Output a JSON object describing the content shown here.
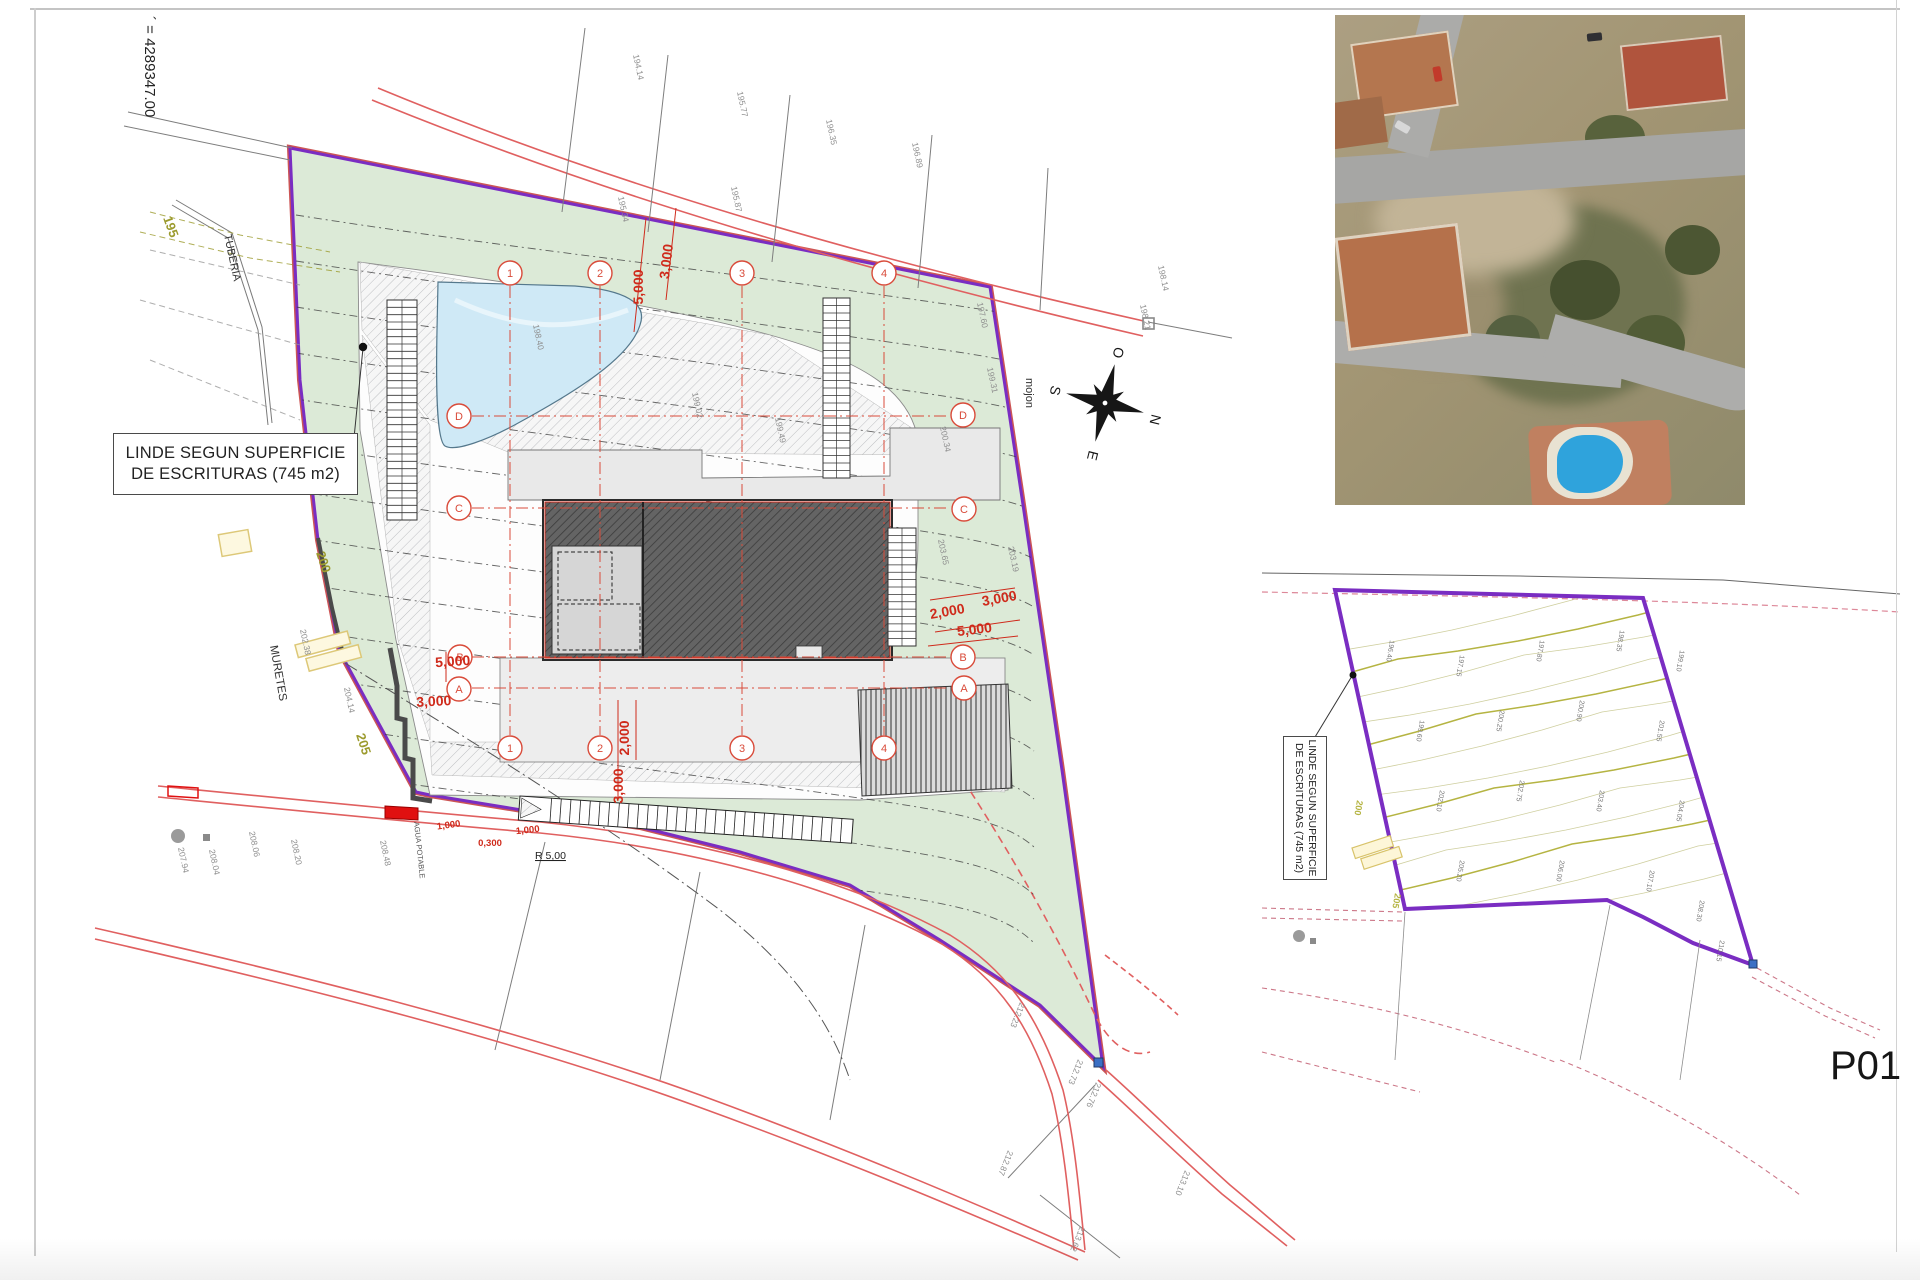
{
  "site_plan": {
    "coordinate_label": "´ = 4289347.00",
    "linde_label_line1": "LINDE SEGUN SUPERFICIE",
    "linde_label_line2": "DE ESCRITURAS (745 m2)",
    "mojon_label": "mojon",
    "tuberia_label": "TUBERIA",
    "muretes_label": "MURETES",
    "agua_potable_label": "AGUA POTABLE",
    "radius_label": "R 5,00",
    "compass": {
      "n": "N",
      "s": "S",
      "e": "E",
      "o": "O"
    },
    "contour_labels": [
      {
        "x": 163,
        "y": 218,
        "r": 70,
        "text": "195"
      },
      {
        "x": 316,
        "y": 553,
        "r": 72,
        "text": "200"
      },
      {
        "x": 356,
        "y": 735,
        "r": 72,
        "text": "205"
      }
    ],
    "grid_bubbles": [
      {
        "x": 510,
        "y": 273,
        "label": "1"
      },
      {
        "x": 600,
        "y": 273,
        "label": "2"
      },
      {
        "x": 742,
        "y": 273,
        "label": "3"
      },
      {
        "x": 884,
        "y": 273,
        "label": "4"
      },
      {
        "x": 510,
        "y": 748,
        "label": "1"
      },
      {
        "x": 600,
        "y": 748,
        "label": "2"
      },
      {
        "x": 742,
        "y": 748,
        "label": "3"
      },
      {
        "x": 884,
        "y": 748,
        "label": "4"
      },
      {
        "x": 459,
        "y": 416,
        "label": "D"
      },
      {
        "x": 459,
        "y": 508,
        "label": "C"
      },
      {
        "x": 460,
        "y": 657,
        "label": "B"
      },
      {
        "x": 459,
        "y": 689,
        "label": "A"
      },
      {
        "x": 963,
        "y": 415,
        "label": "D"
      },
      {
        "x": 964,
        "y": 509,
        "label": "C"
      },
      {
        "x": 963,
        "y": 657,
        "label": "B"
      },
      {
        "x": 964,
        "y": 688,
        "label": "A"
      }
    ],
    "dimensions": [
      {
        "x": 643,
        "y": 287,
        "r": -90,
        "text": "5,000"
      },
      {
        "x": 671,
        "y": 262,
        "r": -83,
        "text": "3,000"
      },
      {
        "x": 948,
        "y": 616,
        "r": -10,
        "text": "2,000"
      },
      {
        "x": 1000,
        "y": 603,
        "r": -10,
        "text": "3,000"
      },
      {
        "x": 975,
        "y": 634,
        "r": -7,
        "text": "5,000"
      },
      {
        "x": 453,
        "y": 666,
        "r": -4,
        "text": "5,000"
      },
      {
        "x": 434,
        "y": 706,
        "r": -3,
        "text": "3,000"
      },
      {
        "x": 629,
        "y": 738,
        "r": -90,
        "text": "2,000"
      },
      {
        "x": 623,
        "y": 786,
        "r": -90,
        "text": "3,000"
      },
      {
        "x": 449,
        "y": 828,
        "r": -8,
        "text": "1,000",
        "size": 9.5
      },
      {
        "x": 528,
        "y": 833,
        "r": -6,
        "text": "1,000",
        "size": 9.5
      },
      {
        "x": 490,
        "y": 846,
        "r": 0,
        "text": "0,300",
        "size": 9.5
      }
    ],
    "survey_points": [
      {
        "x": 633,
        "y": 55,
        "r": 78,
        "text": "194.14"
      },
      {
        "x": 737,
        "y": 92,
        "r": 78,
        "text": "195.77"
      },
      {
        "x": 826,
        "y": 120,
        "r": 78,
        "text": "196.35"
      },
      {
        "x": 912,
        "y": 143,
        "r": 78,
        "text": "196.89"
      },
      {
        "x": 618,
        "y": 197,
        "r": 78,
        "text": "195.34"
      },
      {
        "x": 731,
        "y": 187,
        "r": 78,
        "text": "195.87"
      },
      {
        "x": 1158,
        "y": 266,
        "r": 78,
        "text": "198.14"
      },
      {
        "x": 1140,
        "y": 305,
        "r": 78,
        "text": "198.21"
      },
      {
        "x": 977,
        "y": 303,
        "r": 78,
        "text": "197.60"
      },
      {
        "x": 987,
        "y": 368,
        "r": 78,
        "text": "199.31"
      },
      {
        "x": 940,
        "y": 427,
        "r": 78,
        "text": "200.34"
      },
      {
        "x": 938,
        "y": 540,
        "r": 78,
        "text": "203.65"
      },
      {
        "x": 1008,
        "y": 547,
        "r": 78,
        "text": "203.19"
      },
      {
        "x": 533,
        "y": 325,
        "r": 78,
        "text": "198.40"
      },
      {
        "x": 692,
        "y": 393,
        "r": 78,
        "text": "199.02"
      },
      {
        "x": 775,
        "y": 418,
        "r": 78,
        "text": "199.49"
      },
      {
        "x": 300,
        "y": 630,
        "r": 78,
        "text": "202.38"
      },
      {
        "x": 344,
        "y": 688,
        "r": 78,
        "text": "204.14"
      },
      {
        "x": 178,
        "y": 848,
        "r": 78,
        "text": "207.94"
      },
      {
        "x": 209,
        "y": 850,
        "r": 78,
        "text": "208.04"
      },
      {
        "x": 249,
        "y": 832,
        "r": 78,
        "text": "208.06"
      },
      {
        "x": 291,
        "y": 840,
        "r": 78,
        "text": "208.20"
      },
      {
        "x": 380,
        "y": 841,
        "r": 78,
        "text": "208.48"
      },
      {
        "x": 1020,
        "y": 1002,
        "r": 112,
        "text": "212.23"
      },
      {
        "x": 1078,
        "y": 1059,
        "r": 112,
        "text": "212.73"
      },
      {
        "x": 1096,
        "y": 1082,
        "r": 112,
        "text": "212.76"
      },
      {
        "x": 1008,
        "y": 1150,
        "r": 112,
        "text": "212.87"
      },
      {
        "x": 1185,
        "y": 1170,
        "r": 112,
        "text": "213.10"
      },
      {
        "x": 1080,
        "y": 1226,
        "r": 112,
        "text": "213.62"
      }
    ]
  },
  "survey_inset": {
    "linde_label_line1": "LINDE SEGUN SUPERFICIE",
    "linde_label_line2": "DE ESCRITURAS (745 m2)",
    "contour_labels": [
      {
        "x": 1357,
        "y": 800,
        "r": 100,
        "text": "200"
      },
      {
        "x": 1395,
        "y": 893,
        "r": 100,
        "text": "205"
      }
    ],
    "point_labels": [
      {
        "x": 1390,
        "y": 640,
        "text": "196.40"
      },
      {
        "x": 1460,
        "y": 655,
        "text": "197.15"
      },
      {
        "x": 1540,
        "y": 640,
        "text": "197.80"
      },
      {
        "x": 1620,
        "y": 630,
        "text": "198.35"
      },
      {
        "x": 1680,
        "y": 650,
        "text": "199.10"
      },
      {
        "x": 1420,
        "y": 720,
        "text": "199.60"
      },
      {
        "x": 1500,
        "y": 710,
        "text": "200.25"
      },
      {
        "x": 1580,
        "y": 700,
        "text": "200.90"
      },
      {
        "x": 1660,
        "y": 720,
        "text": "201.55"
      },
      {
        "x": 1440,
        "y": 790,
        "text": "202.10"
      },
      {
        "x": 1520,
        "y": 780,
        "text": "202.75"
      },
      {
        "x": 1600,
        "y": 790,
        "text": "203.40"
      },
      {
        "x": 1680,
        "y": 800,
        "text": "204.05"
      },
      {
        "x": 1460,
        "y": 860,
        "text": "205.20"
      },
      {
        "x": 1560,
        "y": 860,
        "text": "206.00"
      },
      {
        "x": 1650,
        "y": 870,
        "text": "207.10"
      },
      {
        "x": 1700,
        "y": 900,
        "text": "208.30"
      },
      {
        "x": 1720,
        "y": 940,
        "text": "210.15"
      }
    ]
  },
  "sheet_label": "P01",
  "colors": {
    "boundary_purple": "#7a2dc2",
    "boundary_fringe_red": "#cc5555",
    "parcel_green": "#dcead7",
    "road_red": "#e06060",
    "dimension_red": "#cf2a1b",
    "grid_red": "#d94b3a",
    "contour_gray": "#3f3f3f",
    "olive": "#9c9b2e",
    "pool_blue": "#cfe9f6",
    "roof_gray": "#606060",
    "wall_gray": "#4a4a4a",
    "inset_olive": "#b5b442",
    "aerial_pool_blue": "#2fa3dc",
    "aerial_roof_terracotta": "#b5714b"
  }
}
